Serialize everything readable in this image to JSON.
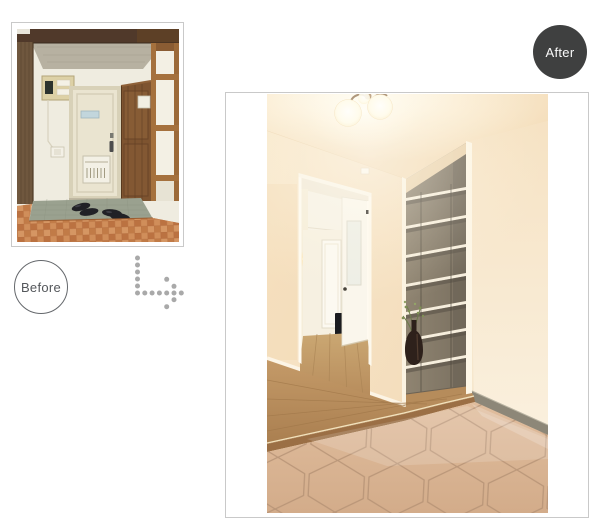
{
  "page": {
    "background": "#ffffff"
  },
  "badges": {
    "before": {
      "label": "Before",
      "fill": "#ffffff",
      "border": "#65686c",
      "text_color": "#54575b"
    },
    "after": {
      "label": "After",
      "fill": "#3f4040",
      "text_color": "#fafafa"
    }
  },
  "arrow_icon": {
    "style": "dotted",
    "direction": "down-then-right",
    "dot_color": "#a9a9a9"
  },
  "frames": {
    "border_color": "#c9c9c9",
    "background": "#ffffff"
  },
  "photos": {
    "before_alt": "Old apartment entryway: dark wood beam and pillar, breaker panel on wall, cream front door with mail slot, glazed wooden partition, black shoes on green tile, orange checkered tile floor",
    "after_alt": "Renovated entryway: warm white walls, twin-globe ceiling light, hallway with open white door, recessed open shoe shelves, branch in dark vase, oak flooring and hexagonal tiled genkan"
  }
}
